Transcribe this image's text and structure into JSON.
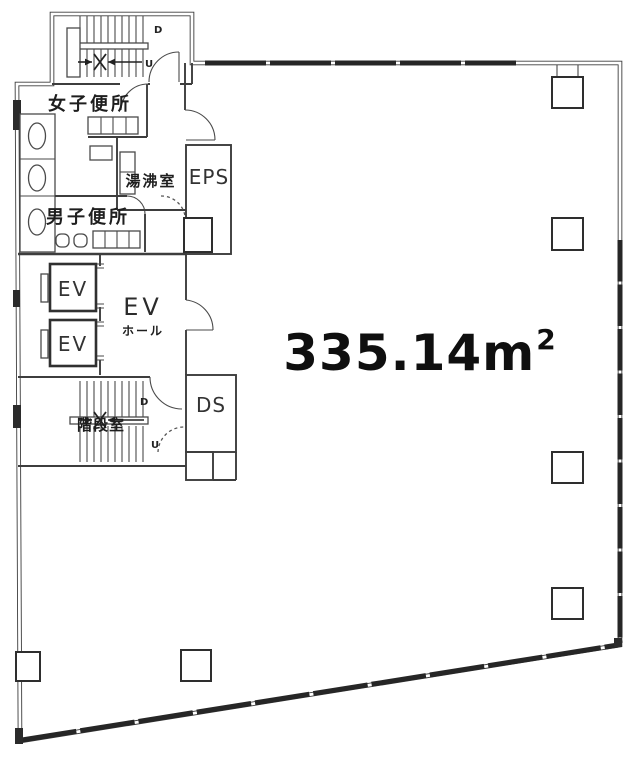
{
  "floor_plan": {
    "area": {
      "value": "335.14m",
      "superscript": "2"
    },
    "rooms": {
      "womens_toilet": "女子便所",
      "kitchenette": "湯沸室",
      "mens_toilet": "男子便所",
      "eps": "EPS",
      "elevator_1": "EV",
      "elevator_2": "EV",
      "ev_hall_line1": "EV",
      "ev_hall_line2": "ホール",
      "stairwell": "階段室",
      "duct_space": "DS"
    },
    "stair_markers": {
      "top_down": "D",
      "top_up": "U",
      "bottom_down": "D",
      "bottom_up": "U"
    }
  }
}
